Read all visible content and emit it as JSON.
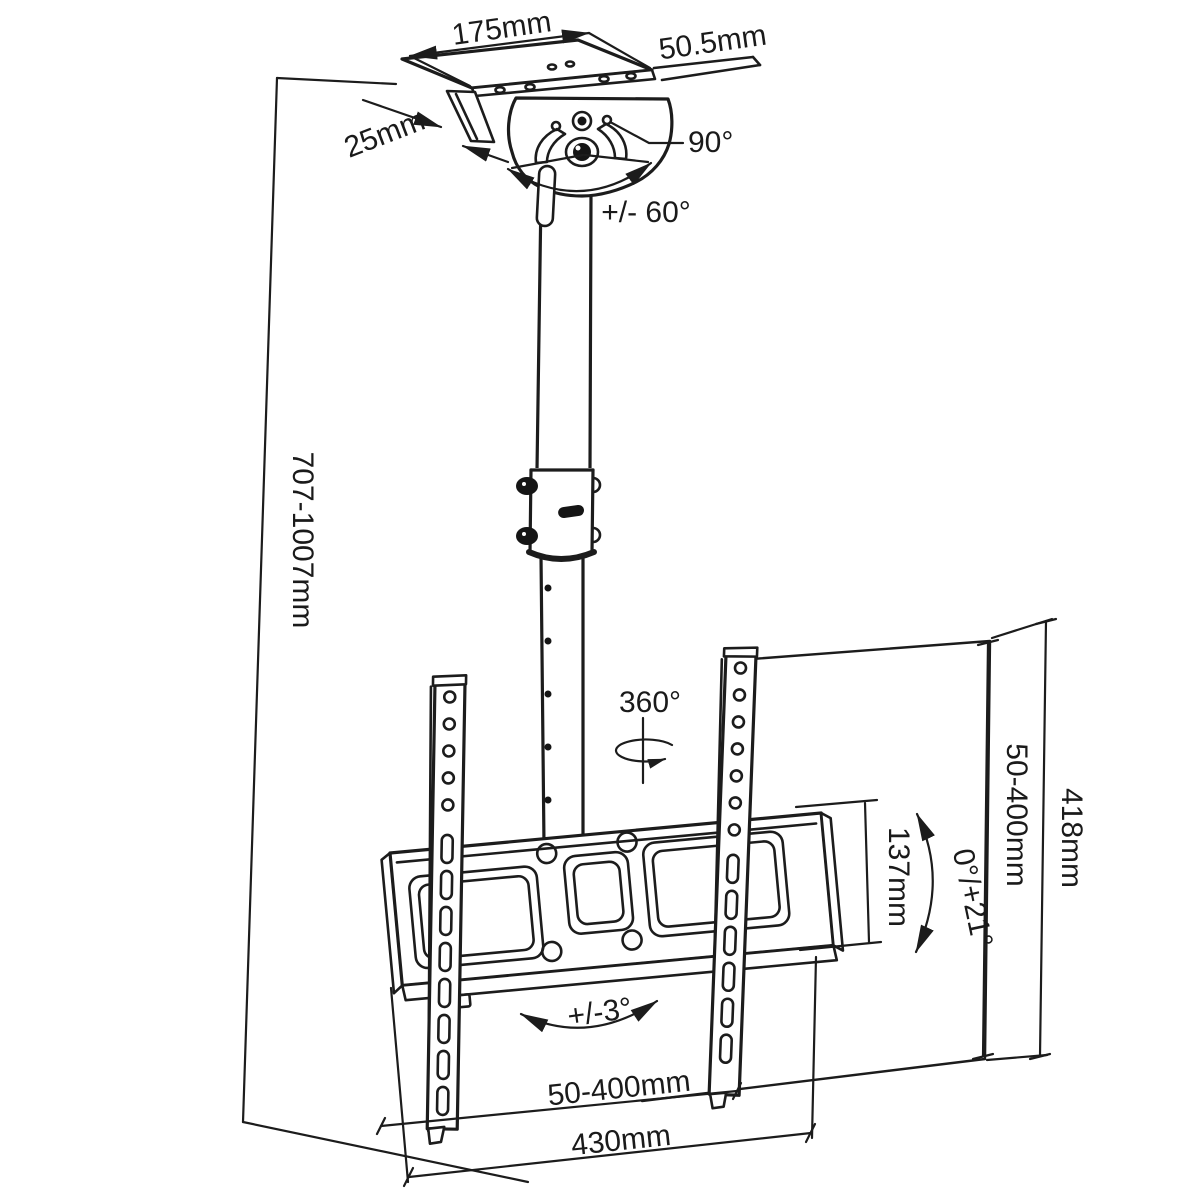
{
  "diagram": {
    "type": "technical_line_drawing",
    "subject": "ceiling TV mount bracket with telescopic pole",
    "colors": {
      "line": "#1c1c1c",
      "background": "#ffffff"
    },
    "dimensions": {
      "ceiling_plate_width": "175mm",
      "ceiling_plate_depth": "50.5mm",
      "ceiling_flange_width": "25mm",
      "swivel_stop_angle": "90°",
      "swivel_range": "+/- 60°",
      "height_range": "707-1007mm",
      "rotation_range": "360°",
      "vesa_vertical_range": "50-400mm",
      "bracket_total_height": "418mm",
      "adapter_plate_height": "137mm",
      "tilt_range": "0°/+21°",
      "level_adjust_range": "+/-3°",
      "vesa_horizontal_range": "50-400mm",
      "adapter_plate_width": "430mm"
    }
  }
}
